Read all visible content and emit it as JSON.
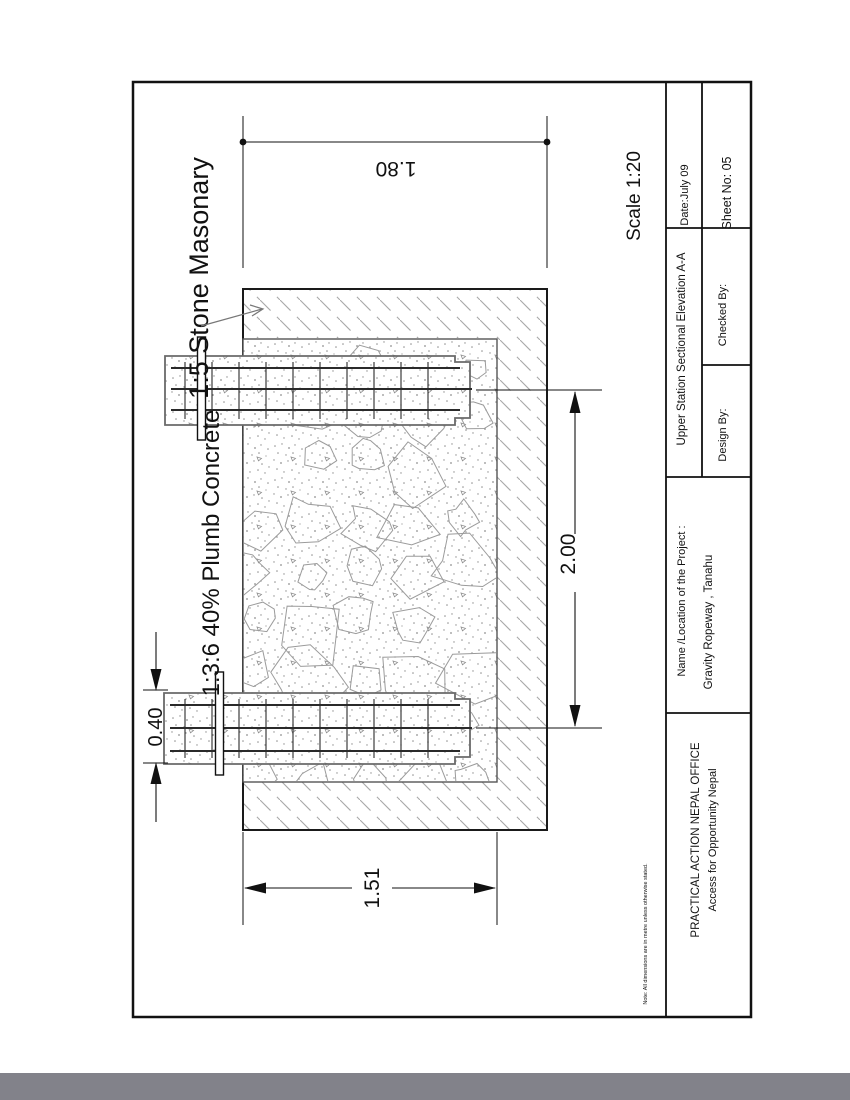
{
  "page": {
    "scale_label": "Scale 1:20",
    "note": "Note: All dimensions are in metre unless otherwise stated."
  },
  "labels": {
    "stone_masonry": "1:5 Stone Masonary",
    "plumb_concrete": "1:3:6 40%  Plumb Concrete"
  },
  "dimensions": {
    "top_width": "1.80",
    "body_height": "2.00",
    "slab_thickness": "0.40",
    "bottom_width": "1.51"
  },
  "title_block": {
    "org_line1": "PRACTICAL ACTION NEPAL OFFICE",
    "org_line2": "Access for Opportunity Nepal",
    "project_label": "Name /Location of the Project :",
    "project_value": "Gravity Ropeway ,  Tanahu",
    "drawing_title": "Upper Station Sectional Elevation A-A",
    "design_by": "Design By:",
    "checked_by": "Checked By:",
    "date": "Date:July 09",
    "sheet_no": "Sheet No: 05"
  },
  "colors": {
    "line": "#111111",
    "hatch": "#a9a9a9",
    "texture": "#8f8f8f",
    "footer_bar": "#82828a"
  }
}
